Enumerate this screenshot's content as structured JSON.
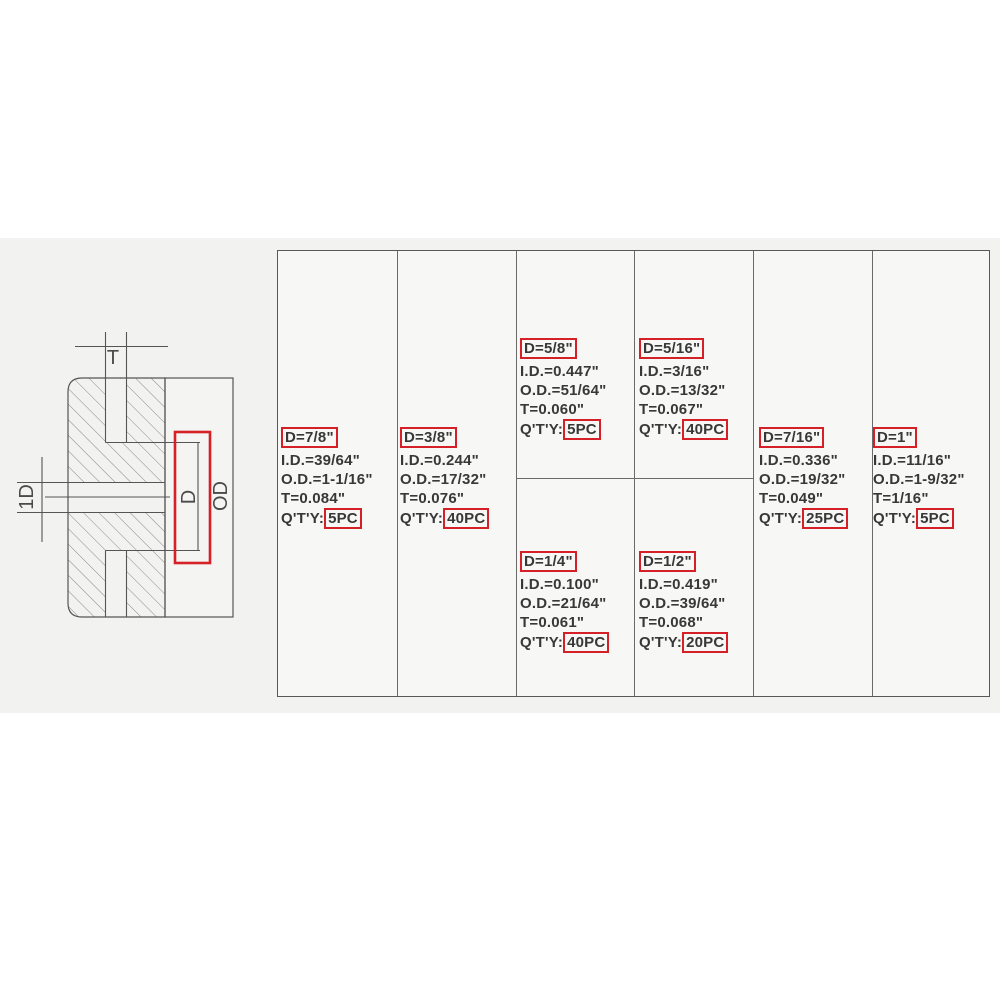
{
  "colors": {
    "highlight_red": "#d42026",
    "grid_line": "#6a6a6a",
    "text": "#383838",
    "band_background": "#f2f2f0",
    "table_background": "#f7f7f6"
  },
  "diagram": {
    "t_label": "T",
    "bore_label": "1D",
    "groove_diameter_label": "D",
    "outer_diameter_label": "OD"
  },
  "table": {
    "cells": [
      {
        "d": "D=7/8\"",
        "id": "I.D.=39/64\"",
        "od": "O.D.=1-1/16\"",
        "t": "T=0.084\"",
        "qty_label": "Q'T'Y:",
        "qty": "5PC"
      },
      {
        "d": "D=3/8\"",
        "id": "I.D.=0.244\"",
        "od": "O.D.=17/32\"",
        "t": "T=0.076\"",
        "qty_label": "Q'T'Y:",
        "qty": "40PC"
      },
      {
        "d": "D=5/8\"",
        "id": "I.D.=0.447\"",
        "od": "O.D.=51/64\"",
        "t": "T=0.060\"",
        "qty_label": "Q'T'Y:",
        "qty": "5PC"
      },
      {
        "d": "D=1/4\"",
        "id": "I.D.=0.100\"",
        "od": "O.D.=21/64\"",
        "t": "T=0.061\"",
        "qty_label": "Q'T'Y:",
        "qty": "40PC"
      },
      {
        "d": "D=5/16\"",
        "id": "I.D.=3/16\"",
        "od": "O.D.=13/32\"",
        "t": "T=0.067\"",
        "qty_label": "Q'T'Y:",
        "qty": "40PC"
      },
      {
        "d": "D=1/2\"",
        "id": "I.D.=0.419\"",
        "od": "O.D.=39/64\"",
        "t": "T=0.068\"",
        "qty_label": "Q'T'Y:",
        "qty": "20PC"
      },
      {
        "d": "D=7/16\"",
        "id": "I.D.=0.336\"",
        "od": "O.D.=19/32\"",
        "t": "T=0.049\"",
        "qty_label": "Q'T'Y:",
        "qty": "25PC"
      },
      {
        "d": "D=1\"",
        "id": "I.D.=11/16\"",
        "od": "O.D.=1-9/32\"",
        "t": "T=1/16\"",
        "qty_label": "Q'T'Y:",
        "qty": "5PC"
      }
    ]
  }
}
